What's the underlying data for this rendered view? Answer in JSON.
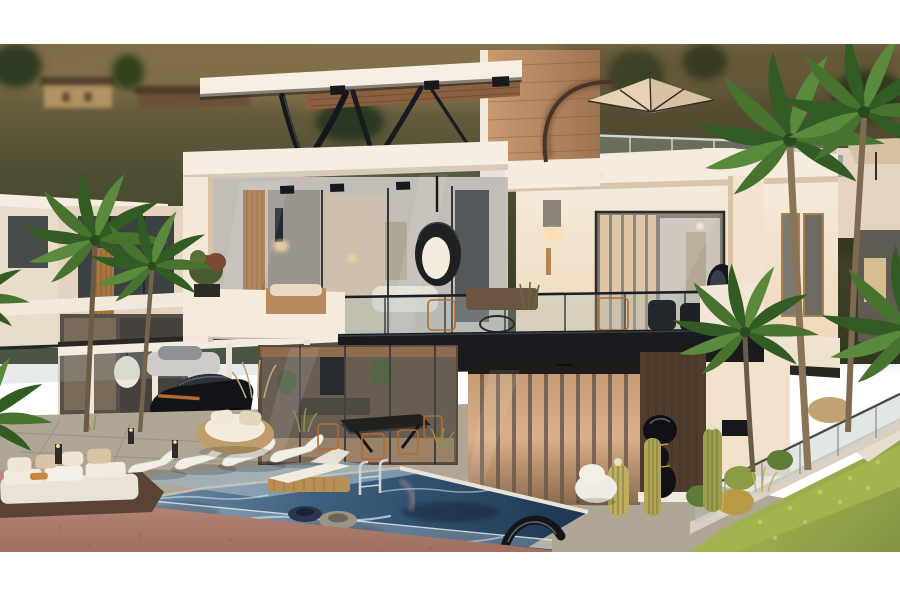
{
  "scene": {
    "type": "architectural-render",
    "subject": "modern two-story luxury villa with rooftop terrace and pool at dusk",
    "setting": "hillside residential development with palm trees and neighboring villas",
    "time_of_day": "dusk",
    "elements": [
      "background-hills",
      "background-houses",
      "neighbor-villas",
      "main-villa",
      "roof-slab",
      "v-struts",
      "travertine-wall",
      "cantilever-umbrella",
      "rooftop-glass-railing",
      "upper-floor-glass-wall",
      "hanging-egg-chair",
      "balcony",
      "balcony-fascia",
      "carport",
      "black-sports-car",
      "living-room-glass",
      "curtain-glass-doors",
      "wood-feature-wall",
      "abstract-sculpture",
      "swimming-pool",
      "pool-ladder",
      "pool-floats",
      "sun-loungers",
      "double-chaise",
      "outdoor-dining-set",
      "round-daybed",
      "corner-sofa",
      "terrace-paving",
      "glass-fence",
      "lawn",
      "hedge",
      "cacti",
      "palm-trees",
      "letterbox-bands"
    ]
  },
  "colors": {
    "frame_white": "#ffffff",
    "hill_top": "#7d6a47",
    "hill_mid": "#4e4e33",
    "hill_dark": "#2c3620",
    "villa_cream": "#f5ecdf",
    "villa_wall_warm": "#eed7b8",
    "accent_charcoal": "#191b1f",
    "travertine_light": "#c99b72",
    "travertine_dark": "#9e7350",
    "wood_soffit": "#8a5f3e",
    "dark_wood_wall": "#4f3c2d",
    "glass_tint": "#a9bcb9",
    "warm_light": "#ffdda6",
    "curtain_tan": "#d9b088",
    "pool_light": "#87a2b4",
    "pool_mid": "#3f6080",
    "pool_deep": "#16304a",
    "coping_white": "#e9e4da",
    "salmon_paving": "#bb8a7c",
    "salmon_paving_dark": "#9e7060",
    "deck_gray": "#b0a695",
    "lawn_light": "#b3bc5a",
    "lawn_dark": "#7e9340",
    "hedge_green": "#a3b44e",
    "palm_green": "#47732f",
    "palm_green_dark": "#335c24",
    "trunk_brown": "#8a7458",
    "umbrella_tan": "#d8c0a4",
    "cactus_gold": "#bfae62",
    "car_black": "#121318",
    "rust_accent": "#b5692f",
    "cushion_cream": "#f2ecdf",
    "sculpture_black": "#101114"
  }
}
